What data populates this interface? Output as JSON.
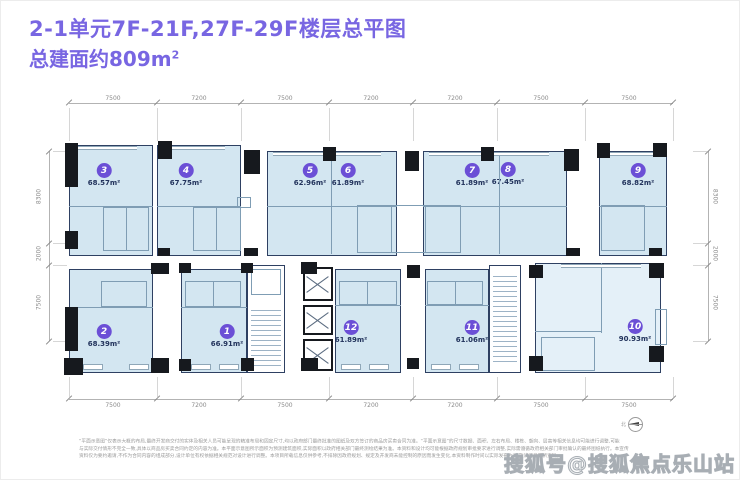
{
  "header": {
    "title": "2-1单元7F-21F,27F-29F楼层总平图",
    "subtitle": "总建面约809m",
    "subtitle_sup": "2"
  },
  "plan": {
    "top_dims": [
      "7500",
      "7200",
      "7500",
      "7200",
      "7200",
      "7500",
      "7500"
    ],
    "bottom_dims": [
      "7500",
      "7200",
      "7500",
      "7200",
      "7200",
      "7500",
      "7500"
    ],
    "left_dims": [
      "8300",
      "2000",
      "7500"
    ],
    "right_dims": [
      "8300",
      "2000",
      "7500"
    ],
    "units": [
      {
        "no": "1",
        "area": "66.91m²"
      },
      {
        "no": "2",
        "area": "68.39m²"
      },
      {
        "no": "3",
        "area": "68.57m²"
      },
      {
        "no": "4",
        "area": "67.75m²"
      },
      {
        "no": "5",
        "area": "62.96m²"
      },
      {
        "no": "6",
        "area": "61.89m²"
      },
      {
        "no": "7",
        "area": "61.89m²"
      },
      {
        "no": "8",
        "area": "67.45m²"
      },
      {
        "no": "9",
        "area": "68.82m²"
      },
      {
        "no": "10",
        "area": "90.93m²"
      },
      {
        "no": "11",
        "area": "61.06m²"
      },
      {
        "no": "12",
        "area": "61.89m²"
      }
    ],
    "north_label": "北"
  },
  "disclaimer": [
    "“平面示意图”仅表示大概的布局,最终开发商交付的实体及相关人员可能呈现的精准布局和固定尺寸,均以政府部门最终批准的图纸及双方签订的商品房买卖合同为准。“平面示意图”的尺寸数据、面积、左右布局、楼栋、朝向、层高等相关信息均可能进行调整,可能",
    "与实际交付情形不完全一致,具体以商品房买卖合同约定的内容为准。本平面示意图所示面积为预测建筑面积,实际面积以政府相关部门最终测绘结果为准。本资料和设计均可能根据政府规划审批要求进行调整,实际需遵循政府相关部门审批确认的最终图纸执行。本宣传",
    "资料仅为要约邀请,不作为合同内容的组成部分,设计单位有权依据相关规范对设计进行调整。本项目所载信息仅供参考,不排除因政府规划、规定及开发商未能控制的原因而发生变化,本资料制作时间以实际发布为准,敬请留意最新资料。"
  ],
  "watermark": "搜狐号@搜狐焦点乐山站",
  "colors": {
    "accent": "#7866e2",
    "badge": "#6b4fd6",
    "room_fill": "#d3e6f1",
    "room_fill_light": "#e4f0f8",
    "wall": "#2e4062"
  }
}
